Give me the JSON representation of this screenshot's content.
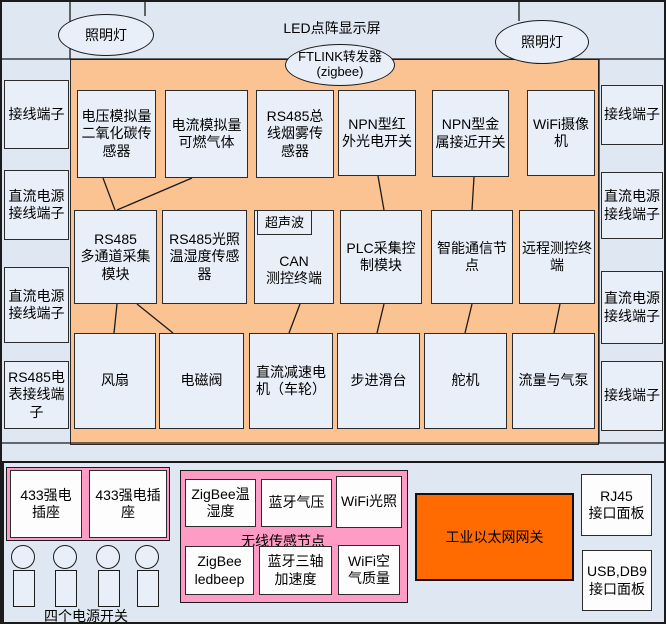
{
  "header": {
    "title": "LED点阵显示屏",
    "lamp_left": "照明灯",
    "lamp_right": "照明灯",
    "ftlink": "FTLINK转发器\n(zigbee)"
  },
  "left_column": [
    "接线端子",
    "直流电源\n接线端子",
    "直流电源\n接线端子",
    "RS485电\n表接线端\n子"
  ],
  "right_column": [
    "接线端子",
    "直流电源\n接线端子",
    "直流电源\n接线端子",
    "接线端子"
  ],
  "grid": {
    "row1": [
      "电压模拟量\n二氧化碳传\n感器",
      "电流模拟量\n可燃气体",
      "RS485总\n线烟雾传\n感器",
      "NPN型红\n外光电开关",
      "NPN型金\n属接近开关",
      "WiFi摄像\n机"
    ],
    "row2": [
      "RS485\n多通道采集\n模块",
      "RS485光照\n温湿度传感\n器",
      "CAN\n测控终端",
      "PLC采集控\n制模块",
      "智能通信节\n点",
      "远程测控终\n端"
    ],
    "ultrasonic": "超声波",
    "row3": [
      "风扇",
      "电磁阀",
      "直流减速电\n机（车轮）",
      "步进滑台",
      "舵机",
      "流量与气泵"
    ]
  },
  "bottom": {
    "sockets": [
      "433强电\n插座",
      "433强电插\n座"
    ],
    "power_switch_label": "四个电源开关",
    "wireless": {
      "label": "无线传感节点",
      "nodes": [
        "ZigBee温\n湿度",
        "蓝牙气压",
        "WiFi光照",
        "ZigBee\nledbeep",
        "蓝牙三轴\n加速度",
        "WiFi空\n气质量"
      ]
    },
    "gateway": "工业以太网网关",
    "io_panels": [
      "RJ45\n接口面板",
      "USB,DB9\n接口面板"
    ]
  },
  "colors": {
    "canvas_bg": "#dfe7f2",
    "panel_orange": "#fbc392",
    "gateway_orange": "#ff6b00",
    "pink": "#ff9cc6",
    "node_fill": "#e9eff9"
  }
}
